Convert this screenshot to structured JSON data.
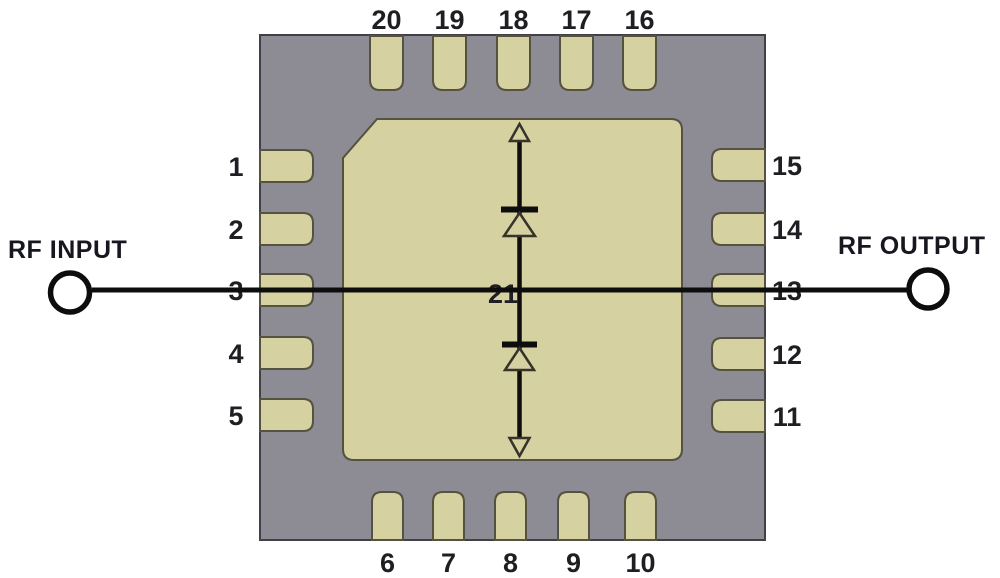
{
  "labels": {
    "rf_input": "RF INPUT",
    "rf_output": "RF OUTPUT"
  },
  "package": {
    "paddle_pin": "21",
    "pins": {
      "top": [
        "20",
        "19",
        "18",
        "17",
        "16"
      ],
      "left": [
        "1",
        "2",
        "3",
        "4",
        "5"
      ],
      "right": [
        "15",
        "14",
        "13",
        "12",
        "11"
      ],
      "bottom": [
        "6",
        "7",
        "8",
        "9",
        "10"
      ]
    }
  },
  "schematic": {
    "symbols": [
      "up-arrow",
      "diode",
      "diode",
      "down-arrow"
    ]
  },
  "colors": {
    "background": "#ffffff",
    "package_body": "#8d8b93",
    "pad": "#d5d1a0",
    "body_outline": "#414047",
    "pad_outline": "#55523f",
    "line": "#0d0d0d",
    "symbol_outline": "#35332a",
    "pin_text": "#1f1e22",
    "rf_text": "#17171f"
  }
}
